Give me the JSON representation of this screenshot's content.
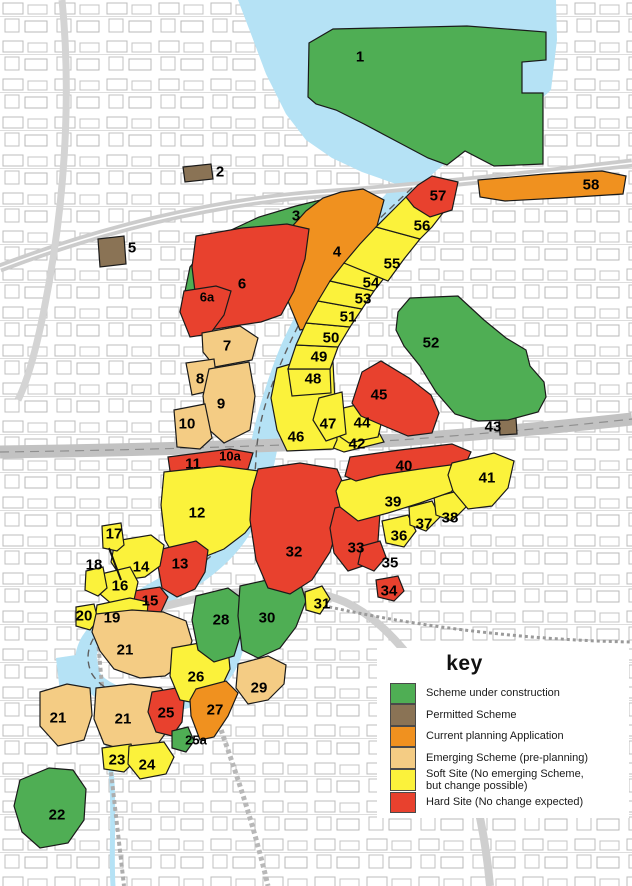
{
  "legend": {
    "title": "key",
    "items": [
      {
        "status": "under-construction",
        "label": "Scheme under construction",
        "color": "#4fae54"
      },
      {
        "status": "permitted",
        "label": "Permitted Scheme",
        "color": "#8a7355"
      },
      {
        "status": "current-application",
        "label": "Current planning Application",
        "color": "#f0911f"
      },
      {
        "status": "emerging",
        "label": "Emerging Scheme (pre-planning)",
        "color": "#f4cc84"
      },
      {
        "status": "soft",
        "label": "Soft Site (No emerging Scheme, but change possible)",
        "label_lines": [
          "Soft Site (No emerging Scheme,",
          "but change possible)"
        ],
        "color": "#fbf23b"
      },
      {
        "status": "hard",
        "label": "Hard Site (No change expected)",
        "color": "#e8412e"
      }
    ]
  },
  "map": {
    "water_color": "#b5e2f5",
    "road_color": "#cccccc",
    "outline_color": "#1a1a1a",
    "sites": [
      {
        "id": "1",
        "label": "1",
        "status": "under-construction"
      },
      {
        "id": "2",
        "label": "2",
        "status": "permitted"
      },
      {
        "id": "3",
        "label": "3",
        "status": "under-construction"
      },
      {
        "id": "4",
        "label": "4",
        "status": "current-application"
      },
      {
        "id": "5",
        "label": "5",
        "status": "permitted"
      },
      {
        "id": "6",
        "label": "6",
        "status": "hard"
      },
      {
        "id": "6a",
        "label": "6a",
        "status": "hard"
      },
      {
        "id": "7",
        "label": "7",
        "status": "emerging"
      },
      {
        "id": "8",
        "label": "8",
        "status": "emerging"
      },
      {
        "id": "9",
        "label": "9",
        "status": "emerging"
      },
      {
        "id": "10",
        "label": "10",
        "status": "emerging"
      },
      {
        "id": "10a",
        "label": "10a",
        "status": ""
      },
      {
        "id": "11",
        "label": "11",
        "status": "hard"
      },
      {
        "id": "12",
        "label": "12",
        "status": "soft"
      },
      {
        "id": "13",
        "label": "13",
        "status": "hard"
      },
      {
        "id": "14",
        "label": "14",
        "status": "soft"
      },
      {
        "id": "15",
        "label": "15",
        "status": "hard"
      },
      {
        "id": "16",
        "label": "16",
        "status": "soft"
      },
      {
        "id": "17",
        "label": "17",
        "status": "soft"
      },
      {
        "id": "18",
        "label": "18",
        "status": "soft"
      },
      {
        "id": "19",
        "label": "19",
        "status": "soft"
      },
      {
        "id": "20",
        "label": "20",
        "status": "soft"
      },
      {
        "id": "21",
        "label": "21",
        "status": "emerging"
      },
      {
        "id": "22",
        "label": "22",
        "status": "under-construction"
      },
      {
        "id": "23",
        "label": "23",
        "status": "soft"
      },
      {
        "id": "24",
        "label": "24",
        "status": "soft"
      },
      {
        "id": "25",
        "label": "25",
        "status": "hard"
      },
      {
        "id": "25a",
        "label": "25a",
        "status": "under-construction"
      },
      {
        "id": "26",
        "label": "26",
        "status": "soft"
      },
      {
        "id": "27",
        "label": "27",
        "status": "current-application"
      },
      {
        "id": "28",
        "label": "28",
        "status": "under-construction"
      },
      {
        "id": "29",
        "label": "29",
        "status": "emerging"
      },
      {
        "id": "30",
        "label": "30",
        "status": "under-construction"
      },
      {
        "id": "31",
        "label": "31",
        "status": "soft"
      },
      {
        "id": "32",
        "label": "32",
        "status": "hard"
      },
      {
        "id": "33",
        "label": "33",
        "status": "hard"
      },
      {
        "id": "34",
        "label": "34",
        "status": "hard"
      },
      {
        "id": "35",
        "label": "35",
        "status": "hard"
      },
      {
        "id": "36",
        "label": "36",
        "status": "soft"
      },
      {
        "id": "37",
        "label": "37",
        "status": "soft"
      },
      {
        "id": "38",
        "label": "38",
        "status": "soft"
      },
      {
        "id": "39",
        "label": "39",
        "status": "soft"
      },
      {
        "id": "40",
        "label": "40",
        "status": "hard"
      },
      {
        "id": "41",
        "label": "41",
        "status": "soft"
      },
      {
        "id": "42",
        "label": "42",
        "status": "soft"
      },
      {
        "id": "43",
        "label": "43",
        "status": "permitted"
      },
      {
        "id": "44",
        "label": "44",
        "status": "soft"
      },
      {
        "id": "45",
        "label": "45",
        "status": "hard"
      },
      {
        "id": "46",
        "label": "46",
        "status": "soft"
      },
      {
        "id": "47",
        "label": "47",
        "status": "soft"
      },
      {
        "id": "48",
        "label": "48",
        "status": "soft"
      },
      {
        "id": "49",
        "label": "49",
        "status": "soft"
      },
      {
        "id": "50",
        "label": "50",
        "status": "soft"
      },
      {
        "id": "51",
        "label": "51",
        "status": "soft"
      },
      {
        "id": "52",
        "label": "52",
        "status": "under-construction"
      },
      {
        "id": "53",
        "label": "53",
        "status": "soft"
      },
      {
        "id": "54",
        "label": "54",
        "status": "soft"
      },
      {
        "id": "55",
        "label": "55",
        "status": "soft"
      },
      {
        "id": "56",
        "label": "56",
        "status": "soft"
      },
      {
        "id": "57",
        "label": "57",
        "status": "hard"
      },
      {
        "id": "58",
        "label": "58",
        "status": "current-application"
      }
    ]
  }
}
